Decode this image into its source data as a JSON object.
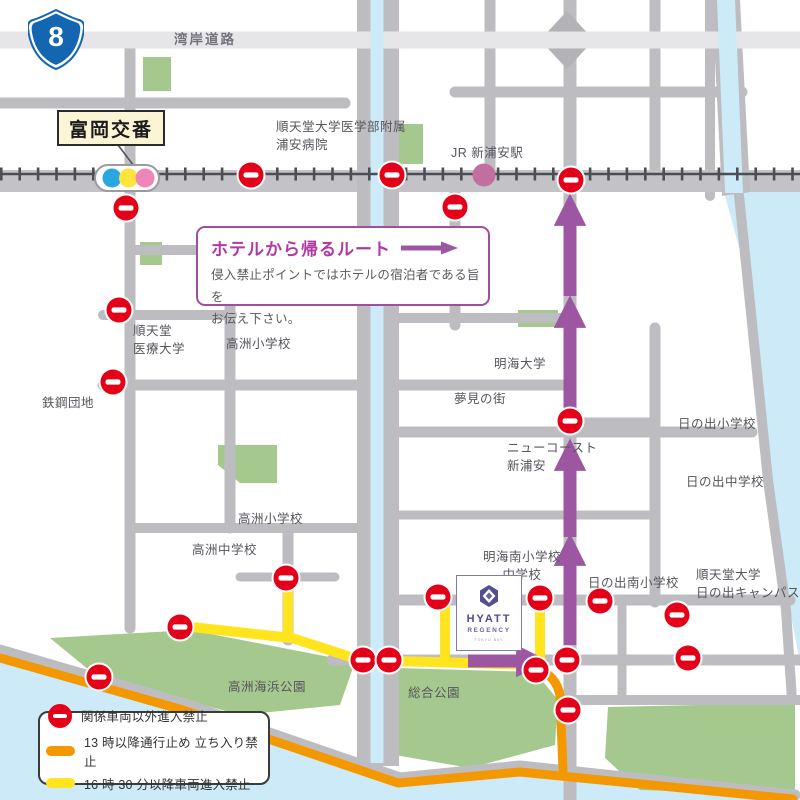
{
  "map": {
    "route_shield_number": "8",
    "road_label": "湾岸道路",
    "police_box_label": "富岡交番",
    "station_label": "JR 新浦安駅",
    "places": {
      "hospital": "順天堂大学医学部附属\n浦安病院",
      "juntendo_medical_univ": "順天堂\n医療大学",
      "takasu_elementary_north": "高洲小学校",
      "tekko_danchi": "鉄鋼団地",
      "meikai_univ": "明海大学",
      "yumemi_no_machi": "夢見の街",
      "new_coast_shin_urayasu": "ニューコースト\n新浦安",
      "hinode_elementary": "日の出小学校",
      "hinode_junior_high": "日の出中学校",
      "takasu_elementary_south": "高洲小学校",
      "takasu_junior_high": "高洲中学校",
      "meikai_minami_schools": "明海南小学校\n中学校",
      "hinode_minami_elementary": "日の出南小学校",
      "juntendo_hinode_campus": "順天堂大学\n日の出キャンパス",
      "takasu_kaihin_park": "高洲海浜公園",
      "sogo_park": "総合公園"
    }
  },
  "info_box": {
    "title": "ホテルから帰るルート",
    "body": "侵入禁止ポイントではホテルの宿泊者である旨を\nお伝え下さい。"
  },
  "hotel": {
    "name_line1": "HYATT",
    "name_line2": "REGENCY",
    "name_line3": "TOKYO BAY"
  },
  "legend": {
    "no_entry": "関係車両以外進入禁止",
    "orange": "13 時以降通行止め 立ち入り禁止",
    "yellow": "16 時 30 分以降車両進入禁止"
  },
  "colors": {
    "no_entry_red": "#e50019",
    "route_orange": "#f39800",
    "route_yellow": "#ffe41e",
    "route_purple": "#9c56a2",
    "water": "#cdeaf8",
    "park": "#a5c88e",
    "road": "#bdbdc1"
  }
}
